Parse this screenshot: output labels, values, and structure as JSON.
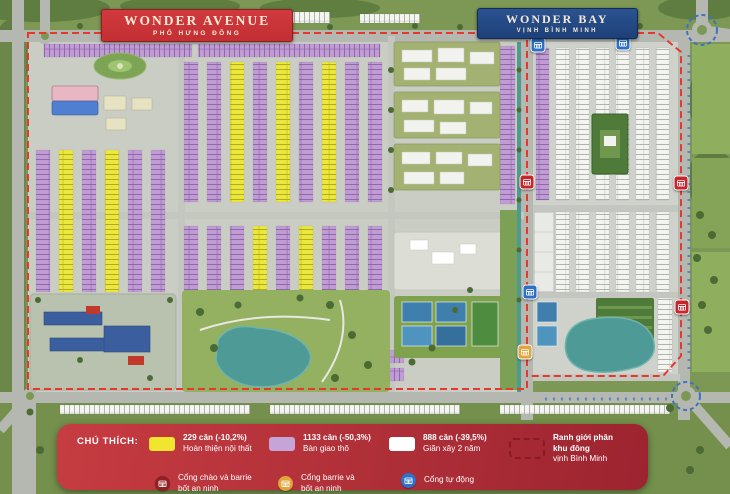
{
  "labels": {
    "wonder_avenue": {
      "title": "WONDER AVENUE",
      "subtitle": "PHỐ HƯNG ĐÔNG"
    },
    "wonder_bay": {
      "title": "WONDER BAY",
      "subtitle": "VỊNH BÌNH MINH"
    }
  },
  "legend": {
    "title": "CHÚ THÍCH:",
    "items": [
      {
        "swatch": "yellow",
        "color": "#f2e52f",
        "line1": "229 căn (-10,2%)",
        "line2": "Hoàn thiện nội thất"
      },
      {
        "swatch": "purple",
        "color": "#c6a4d8",
        "line1": "1133 căn (-50,3%)",
        "line2": "Bàn giao thô"
      },
      {
        "swatch": "white",
        "color": "#ffffff",
        "line1": "888 căn (-39,5%)",
        "line2": "Giãn xây 2 năm"
      },
      {
        "swatch": "dashed-outline",
        "color": "#8a1a22",
        "line1": "Ranh giới phân khu đông",
        "line2": "vịnh Bình Minh"
      }
    ],
    "gates": [
      {
        "icon": "gate-red",
        "color": "#8f2024",
        "line1": "Cổng chào và barrie",
        "line2": "bốt an ninh"
      },
      {
        "icon": "gate-yellow",
        "color": "#e2a43c",
        "line1": "Cổng barrie và",
        "line2": "bốt an ninh"
      },
      {
        "icon": "gate-blue",
        "color": "#2d72c8",
        "line1": "Cổng tự động",
        "line2": ""
      }
    ]
  },
  "map": {
    "gate_markers": [
      {
        "type": "blue",
        "x": 538,
        "y": 45
      },
      {
        "type": "blue",
        "x": 623,
        "y": 43
      },
      {
        "type": "red",
        "x": 527,
        "y": 182
      },
      {
        "type": "red",
        "x": 681,
        "y": 183
      },
      {
        "type": "blue",
        "x": 530,
        "y": 292
      },
      {
        "type": "red",
        "x": 682,
        "y": 307
      },
      {
        "type": "yellow",
        "x": 525,
        "y": 352
      }
    ],
    "marker_colors": {
      "red": "#c5262c",
      "blue": "#2d6fc4",
      "yellow": "#e2a43c"
    },
    "palette": {
      "wonder_avenue_red": "#c42f33",
      "wonder_bay_navy": "#1e4078",
      "legend_red_top": "#c63c41",
      "legend_red_bottom": "#9c2430",
      "boundary_red": "#e8382e",
      "water_teal": "#4e9a96",
      "road_gray": "#b4b8b0",
      "grass_green": "#7c9854",
      "house_yellow": "#ebe73c",
      "house_purple": "#c19bd3",
      "house_white": "#f4f5f1"
    }
  }
}
